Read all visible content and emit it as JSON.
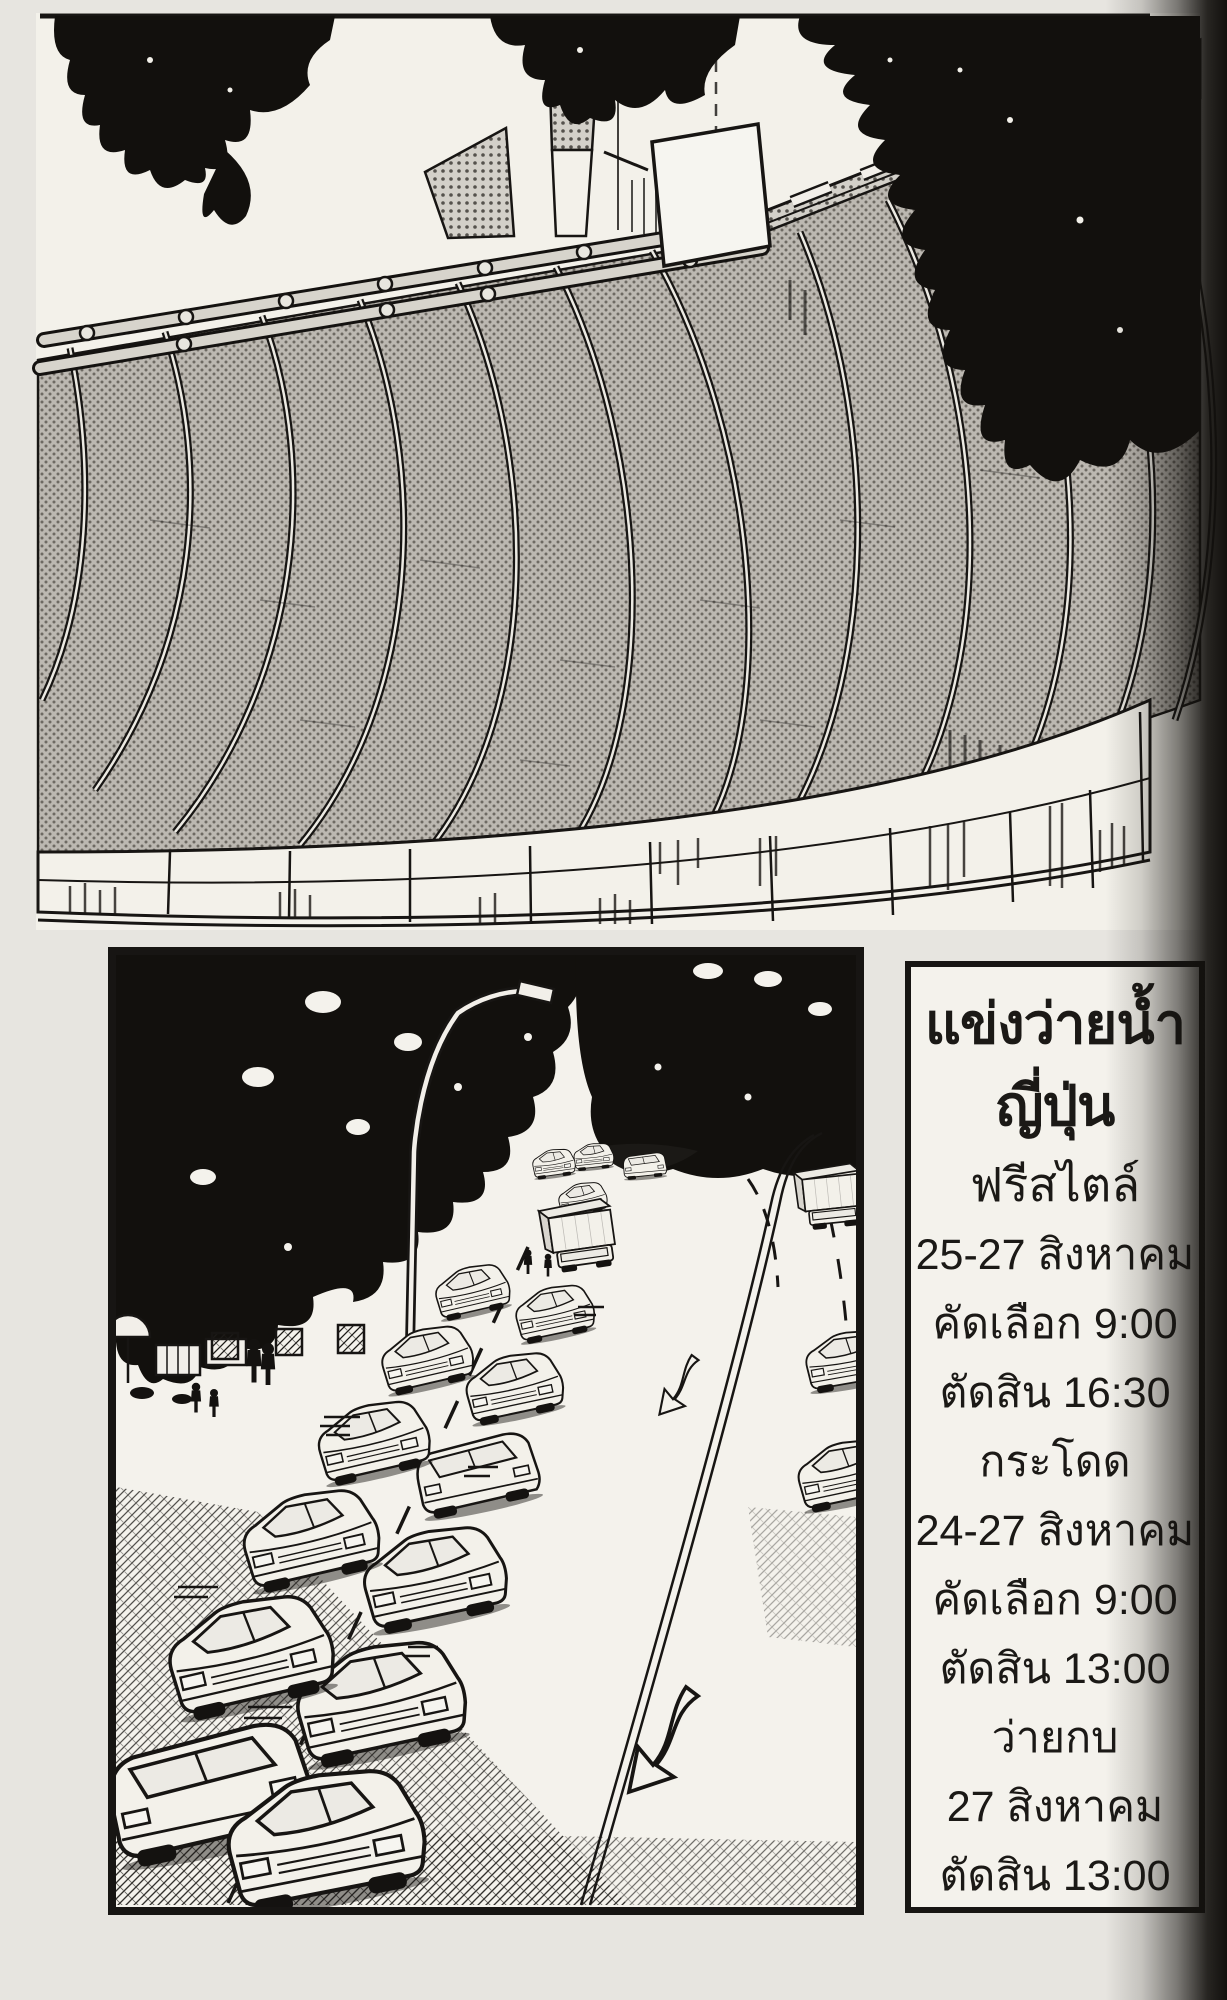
{
  "colors": {
    "paper": "#e7e5e0",
    "panel_background": "#f3f1ea",
    "ink": "#171513",
    "roof_halftone": "#b9b5ae",
    "gutter_shadow": "#12100d"
  },
  "schedule": {
    "lines": [
      {
        "text": "แข่งว่ายน้ำ"
      },
      {
        "text": "ญี่ปุ่น"
      },
      {
        "text": "ฟรีสไตล์"
      },
      {
        "text": "25-27 สิงหาคม"
      },
      {
        "text": "คัดเลือก 9:00"
      },
      {
        "text": "ตัดสิน 16:30"
      },
      {
        "text": "กระโดด"
      },
      {
        "text": "24-27 สิงหาคม"
      },
      {
        "text": "คัดเลือก 9:00"
      },
      {
        "text": "ตัดสิน 13:00"
      },
      {
        "text": "ว่ายกบ"
      },
      {
        "text": "27 สิงหาคม"
      },
      {
        "text": "ตัดสิน 13:00"
      }
    ]
  }
}
